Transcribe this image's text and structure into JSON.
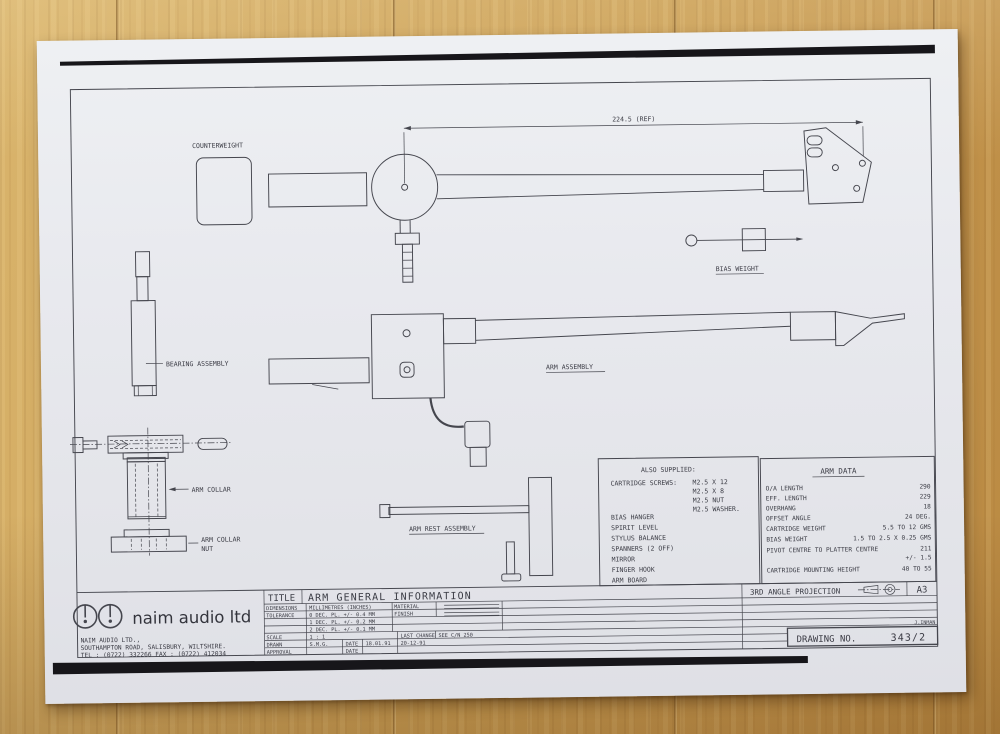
{
  "photo": {
    "surface": "wood-table",
    "wood_color": "#c99d53",
    "paper_color": "#e8e9ee",
    "ink_color": "#3b3c45"
  },
  "drawing": {
    "dimension_ref": "224.5 (REF)",
    "labels": {
      "counterweight": "COUNTERWEIGHT",
      "bias_weight": "BIAS WEIGHT",
      "bearing_assembly": "BEARING ASSEMBLY",
      "arm_assembly": "ARM ASSEMBLY",
      "arm_collar": "ARM COLLAR",
      "arm_collar_nut_line1": "ARM COLLAR",
      "arm_collar_nut_line2": "NUT",
      "arm_rest_assembly": "ARM REST ASSEMBLY"
    },
    "also_supplied": {
      "title": "ALSO SUPPLIED:",
      "cartridge_screws_label": "CARTRIDGE SCREWS:",
      "cartridge_screws": [
        "M2.5 X 12",
        "M2.5 X 8",
        "M2.5 NUT",
        "M2.5 WASHER."
      ],
      "items": [
        "BIAS HANGER",
        "SPIRIT LEVEL",
        "STYLUS BALANCE",
        "SPANNERS (2 OFF)",
        "MIRROR",
        "FINGER HOOK",
        "ARM BOARD"
      ]
    },
    "arm_data": {
      "title": "ARM DATA",
      "rows": [
        {
          "label": "O/A LENGTH",
          "value": "290"
        },
        {
          "label": "EFF. LENGTH",
          "value": "229"
        },
        {
          "label": "OVERHANG",
          "value": "18"
        },
        {
          "label": "OFFSET ANGLE",
          "value": "24 DEG."
        },
        {
          "label": "CARTRIDGE WEIGHT",
          "value": "5.5 TO 12 GMS"
        },
        {
          "label": "BIAS WEIGHT",
          "value": "1.5 TO 2.5 X 0.25 GMS"
        },
        {
          "label": "PIVOT CENTRE TO PLATTER CENTRE",
          "value": "211",
          "value2": "+/- 1.5"
        },
        {
          "label": "CARTRIDGE MOUNTING HEIGHT",
          "value": "40 TO 55"
        }
      ]
    }
  },
  "title_block": {
    "title_label": "TITLE",
    "title": "ARM GENERAL INFORMATION",
    "dimensions_label": "DIMENSIONS",
    "dimensions_value": "MILLIMETRES (INCHES)",
    "material_label": "MATERIAL",
    "finish_label": "FINISH",
    "tolerance_label": "TOLERANCE",
    "tolerance_rows": [
      "0 DEC. PL. +/- 0.4 MM",
      "1 DEC. PL. +/- 0.2 MM",
      "2 DEC. PL. +/- 0.1 MM"
    ],
    "scale_label": "SCALE",
    "scale_value": "1 : 1",
    "drawn_label": "DRAWN",
    "drawn_value": "S.M.G.",
    "date_label": "DATE",
    "drawn_date": "18.01.91",
    "approval_label": "APPROVAL",
    "approval_date_label": "DATE",
    "last_change_label": "LAST CHANGE",
    "last_change_ref": "SEE C/N 250",
    "last_change_date": "20-12-91",
    "projection_label": "3RD ANGLE PROJECTION",
    "sheet_size": "A3",
    "drawing_no_label": "DRAWING NO.",
    "drawing_no_value": "343/2",
    "changed_by": "J.INMAN",
    "company": {
      "logo_text": "naim audio ltd",
      "address_line1": "NAIM AUDIO LTD.,",
      "address_line2": "SOUTHAMPTON ROAD, SALISBURY, WILTSHIRE.",
      "address_line3": "TEL : (0722) 332266 FAX : (0722) 412034"
    }
  }
}
